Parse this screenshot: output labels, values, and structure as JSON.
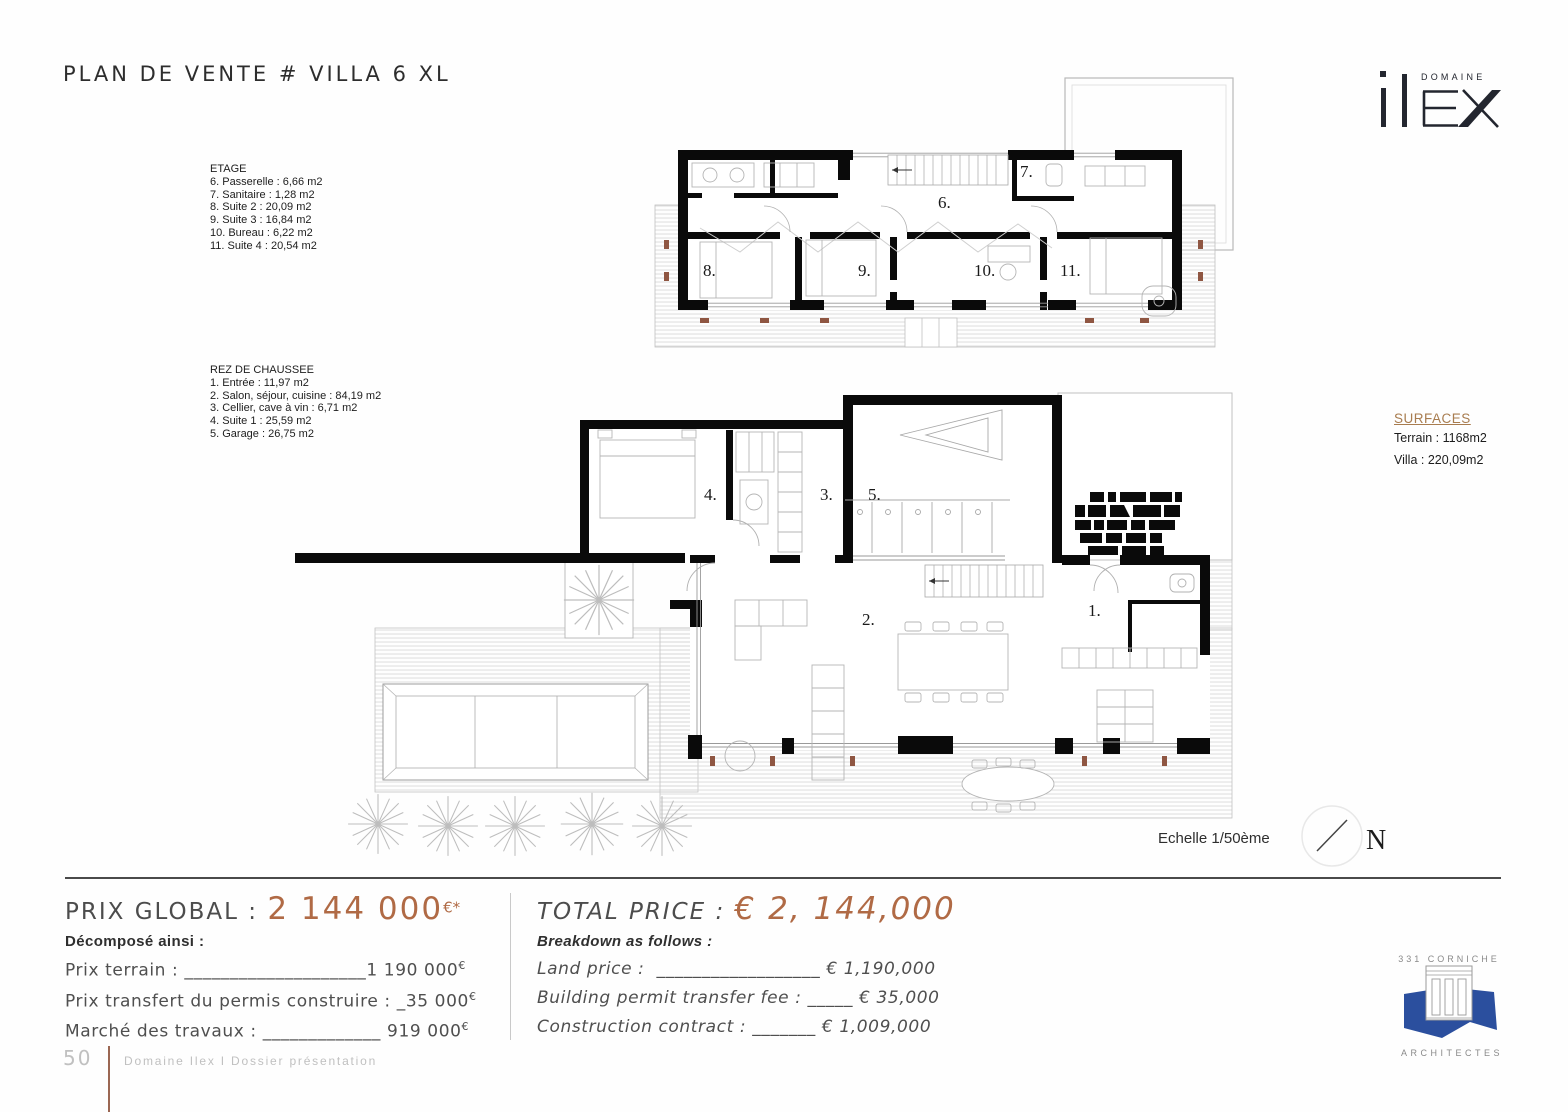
{
  "title": "PLAN DE VENTE # VILLA 6 XL",
  "brand": {
    "top_label": "DOMAINE"
  },
  "etage": {
    "heading": "ETAGE",
    "items": [
      "6. Passerelle : 6,66 m2",
      "7. Sanitaire : 1,28 m2",
      "8. Suite 2 : 20,09 m2",
      "9. Suite 3 : 16,84 m2",
      "10. Bureau : 6,22 m2",
      "11. Suite 4 : 20,54 m2"
    ]
  },
  "rdc": {
    "heading": "REZ DE CHAUSSEE",
    "items": [
      "1. Entrée : 11,97 m2",
      "2. Salon, séjour, cuisine : 84,19 m2",
      "3. Cellier, cave à vin : 6,71  m2",
      "4. Suite 1 : 25,59 m2",
      "5. Garage : 26,75 m2"
    ]
  },
  "surfaces": {
    "heading": "SURFACES",
    "terrain": "Terrain : 1168m2",
    "villa": "Villa : 220,09m2"
  },
  "plan": {
    "scale_label": "Echelle 1/50ème",
    "north_label": "N",
    "labels": {
      "r1": "1.",
      "r2": "2.",
      "r3": "3.",
      "r4": "4.",
      "r5": "5.",
      "r6": "6.",
      "r7": "7.",
      "r8": "8.",
      "r9": "9.",
      "r10": "10.",
      "r11": "11."
    }
  },
  "pricing_fr": {
    "title_label": "PRIX GLOBAL : ",
    "amount": "2 144 000",
    "amount_sup": "€*",
    "sub": "Décomposé ainsi :",
    "rows": [
      {
        "label": "Prix terrain : ",
        "fill": "____________________",
        "value": "1 190 000",
        "sup": "€"
      },
      {
        "label": "Prix transfert du permis construire : ",
        "fill": "_",
        "value": "35 000",
        "sup": "€"
      },
      {
        "label": "Marché des travaux : ",
        "fill": "_____________ ",
        "value": "919 000",
        "sup": "€"
      }
    ]
  },
  "pricing_en": {
    "title_label": "TOTAL PRICE : ",
    "amount": "€ 2, 144,000",
    "sub": "Breakdown as follows :",
    "rows": [
      {
        "label": "Land price :  ",
        "fill": "__________________ ",
        "value": "€ 1,190,000"
      },
      {
        "label": "Building permit transfer fee : ",
        "fill": "_____ ",
        "value": "€ 35,000"
      },
      {
        "label": "Construction contract : ",
        "fill": "_______ ",
        "value": "€ 1,009,000"
      }
    ]
  },
  "architects": {
    "line1": "331 CORNICHE",
    "line2": "ARCHITECTES"
  },
  "footer": {
    "page_number": "50",
    "text": "Domaine Ilex I Dossier présentation"
  },
  "colors": {
    "accent": "#b06a45",
    "surfaces_heading": "#a87c4f",
    "architect_blue": "#2b4f9e",
    "logo_navy": "#23262f"
  }
}
